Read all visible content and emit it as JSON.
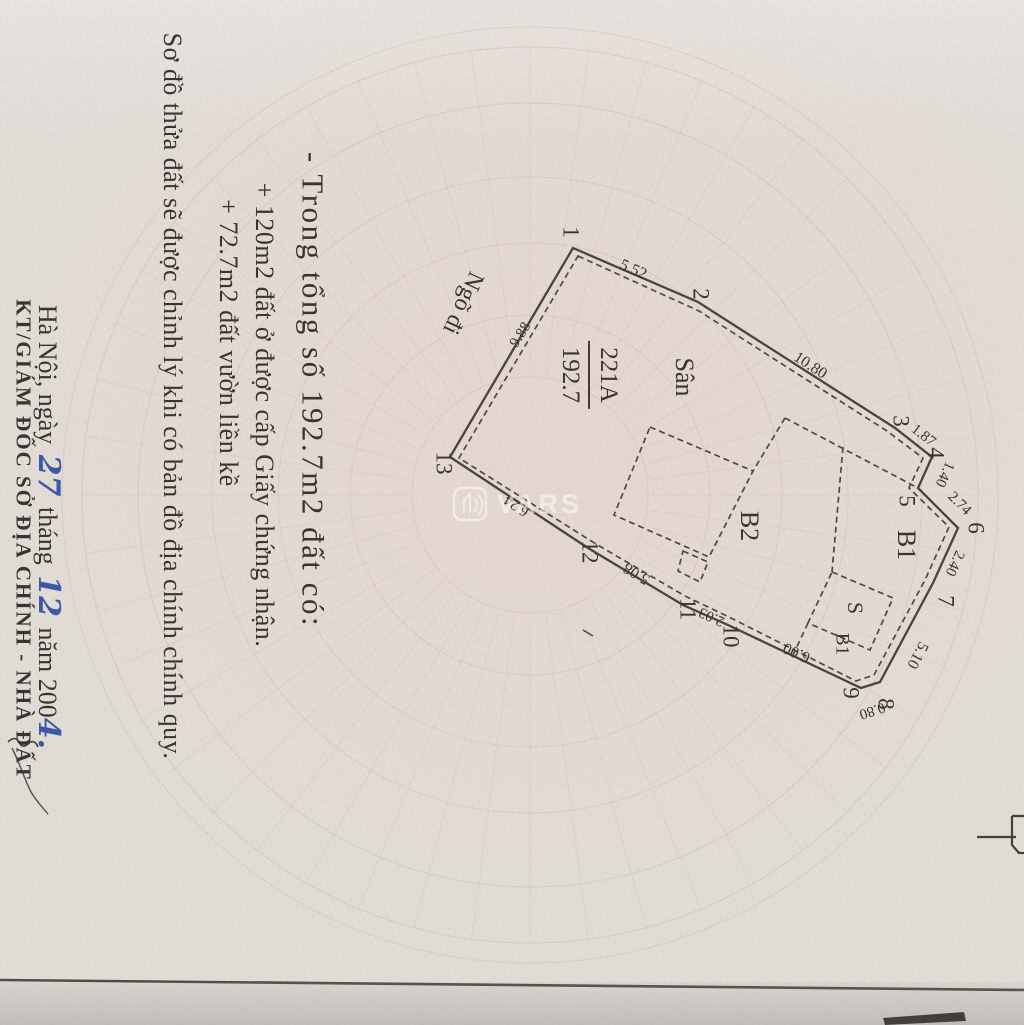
{
  "page": {
    "notes": [
      "- Trong tổng số 192.7m2 đất có:",
      "+ 120m2 đất ở được cấp Giấy chứng nhận.",
      "+ 72.7m2 đất vườn liền kề"
    ],
    "revision_note": "Sơ đồ thửa đất sẽ được chỉnh lý khi có bản đồ địa chính chính quy.",
    "signature": {
      "place_prefix": "Hà Nội, ngày",
      "day": "27",
      "month_word": "tháng",
      "month": "12",
      "year_word": "năm 200",
      "year_digit": "4.",
      "title": "KT/GIÁM ĐỐC SỞ ĐỊA CHÍNH - NHÀ ĐẤT"
    }
  },
  "plot": {
    "parcel_number": "221A",
    "area": "192.7",
    "alley": "Ngõ đi",
    "labels": {
      "san": "Sân",
      "b2": "B2",
      "b1": "B1",
      "s": "S",
      "b1_small": "B1"
    },
    "vertices": [
      "1",
      "2",
      "3",
      "4",
      "5",
      "6",
      "7",
      "8",
      "9",
      "10",
      "11",
      "12",
      "13"
    ],
    "dimensions": [
      "5.52",
      "10.80",
      "1.87",
      "1.40",
      "2.74",
      "2.40",
      "5.10",
      "0.80",
      "6.00",
      "2.03",
      "5.08",
      "6.24",
      "9.88"
    ]
  },
  "watermark": {
    "text": "VARS"
  }
}
